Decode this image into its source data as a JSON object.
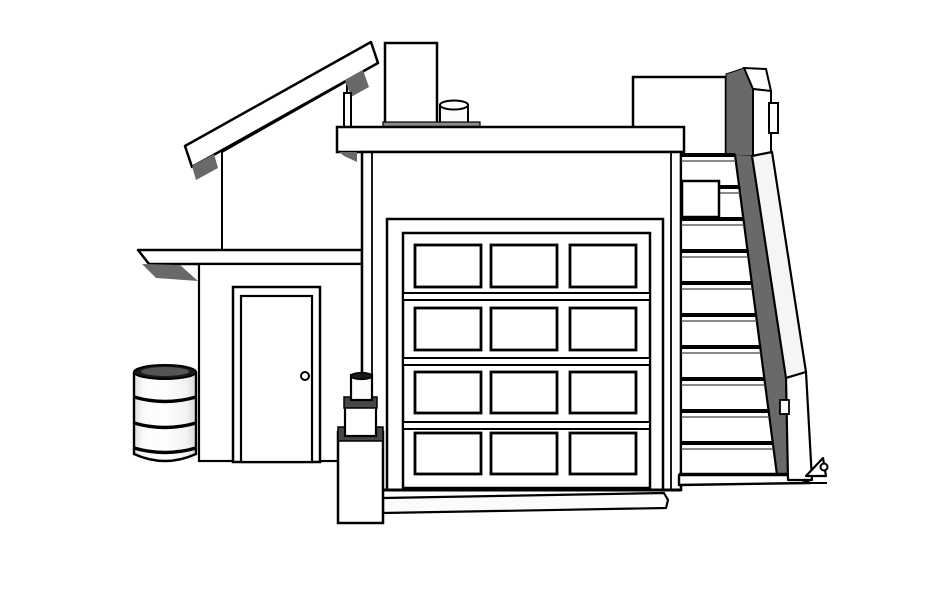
{
  "meta": {
    "title": "Monochrome 3D hidden-line drawing of a flat-roof garage with mono-pitch roof, exterior staircase, barrel and standpipe",
    "style": "CAD / SketchUp style line render, front elevation view"
  },
  "canvas": {
    "width": 942,
    "height": 598,
    "background": "#ffffff"
  },
  "colors": {
    "line": "#000000",
    "face": "#ffffff",
    "shadow": "#696969",
    "light_face": "#f5f5f5",
    "mid_gray": "#8a8a8a",
    "dark_cap": "#474747",
    "barrel_top": "#1a1a1a",
    "barrel_top_inner": "#555555",
    "off_white": "#fbfbfb",
    "tread_line": "#444444"
  },
  "objects": {
    "shed_roof": {
      "label": "mono-pitch roof with fascia board",
      "shadow_wedges": 2
    },
    "gable_wall": {
      "label": "upper gable wall under sloped roof"
    },
    "chimney": {
      "label": "rooftop chimney box"
    },
    "roof_vent": {
      "label": "small rooftop vent cylinder"
    },
    "parapet_cap": {
      "label": "flat parapet cap over garage facade"
    },
    "lean_to": {
      "label": "lean-to side room with flat eave"
    },
    "side_door": {
      "label": "entry door with round knob",
      "has_knob": true
    },
    "garage_facade": {
      "label": "garage front wall"
    },
    "garage_door": {
      "label": "sectional garage door",
      "panel_rows": 4,
      "panel_columns": 3,
      "panel_count": 12,
      "rail_count": 3
    },
    "threshold": {
      "label": "concrete threshold strip below door"
    },
    "staircase": {
      "label": "exterior concrete staircase rising to roof level",
      "step_count": 10,
      "has_landing_box": true,
      "has_meter_box": true,
      "railing": "solid sloped parapet railing with post"
    },
    "spigot": {
      "label": "small spigot at stair base"
    },
    "barrel": {
      "label": "open-top steel drum",
      "rib_count": 3
    },
    "standpipe": {
      "label": "three-tier standpipe pedestal with pipe",
      "tier_count": 3
    }
  }
}
